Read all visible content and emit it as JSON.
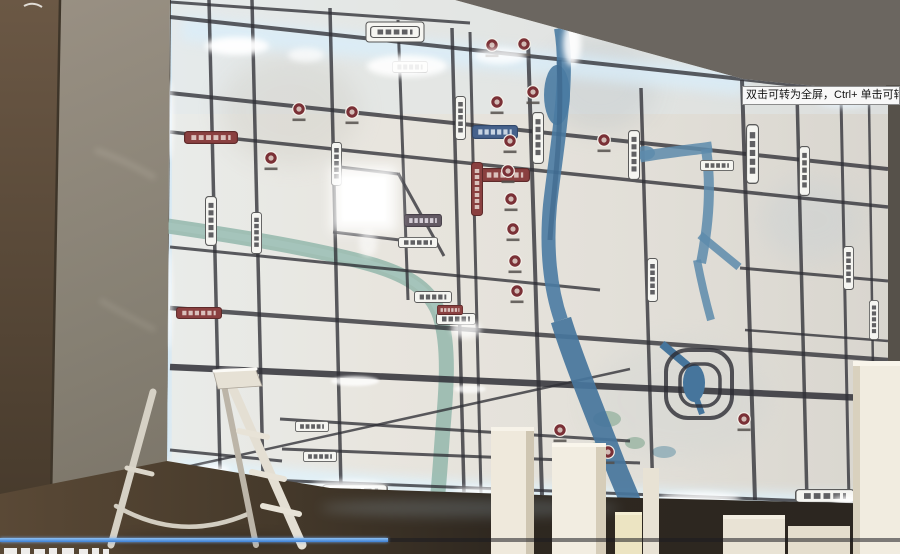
{
  "player": {
    "tooltip": "双击可转为全屏，Ctrl+ 单击可转为",
    "progress": {
      "percent": 43,
      "fill_style": "width:43.1%"
    }
  },
  "colors": {
    "progress_fill_blue": "#3c7fd4",
    "map_backlight_glow": "#d9eefb",
    "map_base": "#e6e3dc",
    "map_road": "#2f2f36",
    "map_river": "#4a7ba2",
    "map_red_label": "#8a4040",
    "wall": "#868073",
    "floor": "#3a3126"
  },
  "scene": {
    "objects": [
      "illuminated-map-board",
      "aluminum-step-ladder",
      "white-boxes",
      "concrete-wall",
      "floor"
    ]
  }
}
